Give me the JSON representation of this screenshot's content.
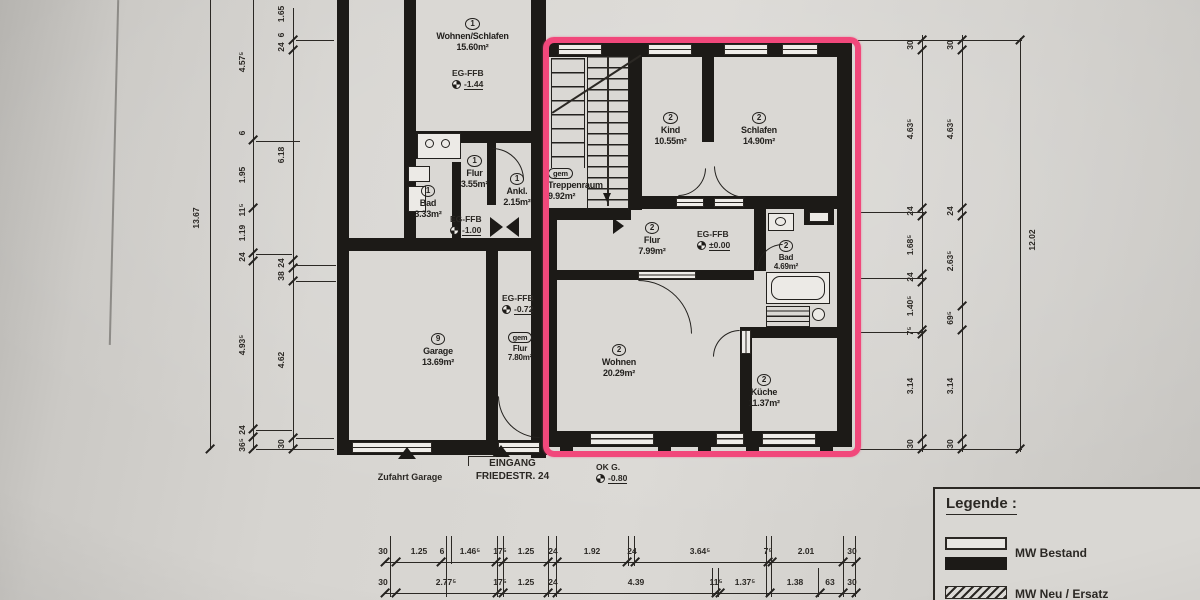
{
  "colors": {
    "highlight": "#f1487b",
    "wall": "#1c1a17",
    "paper": "#d6d4d0"
  },
  "rooms": {
    "wohnen_schlafen": {
      "num": "1",
      "name": "Wohnen/Schlafen",
      "area": "15.60m²"
    },
    "flur1": {
      "num": "1",
      "name": "Flur",
      "area": "3.55m²"
    },
    "ankl": {
      "num": "1",
      "name": "Ankl.",
      "area": "2.15m²"
    },
    "bad1": {
      "num": "1",
      "name": "Bad",
      "area": "3.33m²"
    },
    "treppenraum": {
      "num": "gem",
      "name": "Treppenraum",
      "area": "9.92m²"
    },
    "kind": {
      "num": "2",
      "name": "Kind",
      "area": "10.55m²"
    },
    "schlafen": {
      "num": "2",
      "name": "Schlafen",
      "area": "14.90m²"
    },
    "flur2": {
      "num": "2",
      "name": "Flur",
      "area": "7.99m²"
    },
    "bad2": {
      "num": "2",
      "name": "Bad",
      "area": "4.69m²"
    },
    "wohnen": {
      "num": "2",
      "name": "Wohnen",
      "area": "20.29m²"
    },
    "kueche": {
      "num": "2",
      "name": "Küche",
      "area": "11.37m²"
    },
    "garage": {
      "num": "9",
      "name": "Garage",
      "area": "13.69m²"
    },
    "flur_gem": {
      "num": "gem",
      "name": "Flur",
      "area": "7.80m²"
    }
  },
  "levels": {
    "eg144": {
      "label": "EG-FFB",
      "value": "-1.44"
    },
    "eg100": {
      "label": "EG-FFB",
      "value": "-1.00"
    },
    "eg072": {
      "label": "EG-FFB",
      "value": "-0.72"
    },
    "eg000": {
      "label": "EG-FFB",
      "value": "±0.00"
    },
    "okg": {
      "label": "OK G.",
      "value": "-0.80"
    }
  },
  "annotations": {
    "zufahrt": "Zufahrt Garage",
    "eingang_line1": "EINGANG",
    "eingang_line2": "FRIEDESTR. 24"
  },
  "legend": {
    "title": "Legende :",
    "item1": "MW Bestand",
    "item2": "MW Neu / Ersatz"
  },
  "dims": {
    "left_total": "13.67",
    "right_total": "12.02",
    "la": [
      "4.57⁵",
      "6",
      "1.95",
      "11⁵",
      "1.19",
      "24",
      "4.93⁵",
      "24",
      "36⁵"
    ],
    "lb": [
      "1.65",
      "6",
      "24",
      "6.18",
      "24",
      "38",
      "4.62",
      "30"
    ],
    "ra": [
      "30",
      "4.63⁵",
      "24",
      "1.68⁵",
      "24",
      "1.40⁵",
      "7⁵",
      "3.14",
      "30"
    ],
    "rb": [
      "30",
      "4.63⁵",
      "24",
      "2.63⁵",
      "69⁵",
      "3.14",
      "30"
    ],
    "b1": [
      "30",
      "1.25",
      "6",
      "1.46⁵",
      "17⁵",
      "1.25",
      "24",
      "1.92",
      "24",
      "3.64⁵",
      "7⁵",
      "2.01",
      "30"
    ],
    "b2": [
      "30",
      "2.77⁵",
      "17⁵",
      "1.25",
      "24",
      "4.39",
      "11⁵",
      "1.37⁵",
      "1.38",
      "63",
      "30"
    ]
  }
}
